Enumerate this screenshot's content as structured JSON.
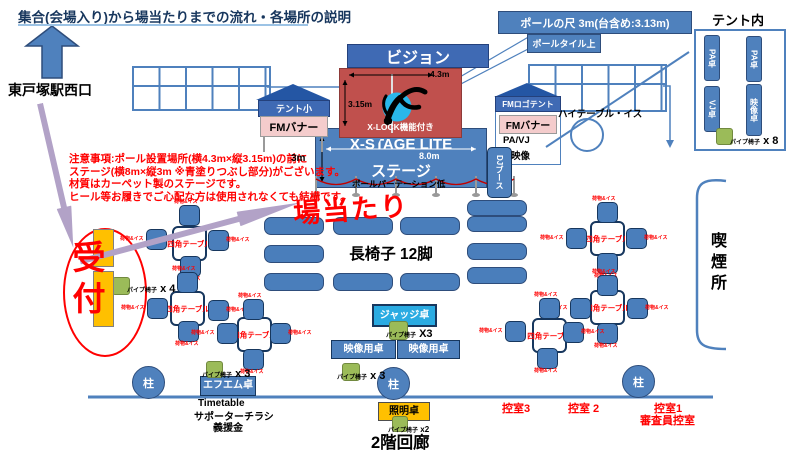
{
  "title": "集合(会場入り)から場当たりまでの流れ・各場所の説明",
  "station": {
    "label": "東戸塚駅西口"
  },
  "notes": {
    "line1": "注意事項:ポール設置場所(横4.3m×縦3.15m)の前に",
    "line2": "ステージ(横8m×縦3m ※青塗りつぶし部分)がございます。",
    "line3": "材質はカーペット製のステージです。",
    "line4": "ヒール等お履きでご心配な方は使用されなくても結構です。"
  },
  "callouts": {
    "pole_height": "ポールの尺 3m(台含め:3.13m)",
    "pole_tile": "ポールタイル上"
  },
  "stage": {
    "vision": "ビジョン",
    "pole_width": "4.3m",
    "pole_height": "3.15m",
    "xlock": "X-LOCK機能付き",
    "name": "X-STAGE LITE",
    "width": "8.0m",
    "label": "ステージ",
    "depth": "3m",
    "partition": "ポールパーテーション低",
    "dj_booth": "DJブース"
  },
  "tents": {
    "small_tent": {
      "name": "テント小",
      "banner": "FMバナー"
    },
    "fm_tent": {
      "name": "FMロゴテント",
      "banner": "FMバナー",
      "pa_vj": "PA/VJ",
      "video": "映像"
    },
    "high_table": "ハイテーブル・イス"
  },
  "tent_interior": {
    "heading": "テント内",
    "tables": [
      "PA卓",
      "PA卓",
      "VJ卓",
      "映像卓"
    ]
  },
  "pipe_chairs": {
    "label": "パイプ椅子",
    "counts": {
      "reception": "x 4",
      "judge": "X3",
      "video": "x 3",
      "fm": "x 3",
      "light": "x2",
      "tent": "x 8"
    }
  },
  "floor": {
    "baatari": "場当たり",
    "bench_label": "長椅子 12脚",
    "judge_table": "ジャッジ卓",
    "video_table1": "映像用卓",
    "video_table2": "映像用卓",
    "square_table_label": "四角テーブル",
    "chair_label": "荷物&イス"
  },
  "reception": {
    "label": "受付"
  },
  "bottom": {
    "fm_table": "エフエム卓",
    "flyer1": "Timetable",
    "flyer2": "サポーターチラシ",
    "flyer3": "義援金",
    "light_table": "照明卓",
    "corridor": "2階回廊",
    "pillar": "柱",
    "room3": "控室3",
    "room2": "控室 2",
    "room1": "控室1",
    "judge_room": "審査員控室"
  },
  "smoking": "喫煙所"
}
